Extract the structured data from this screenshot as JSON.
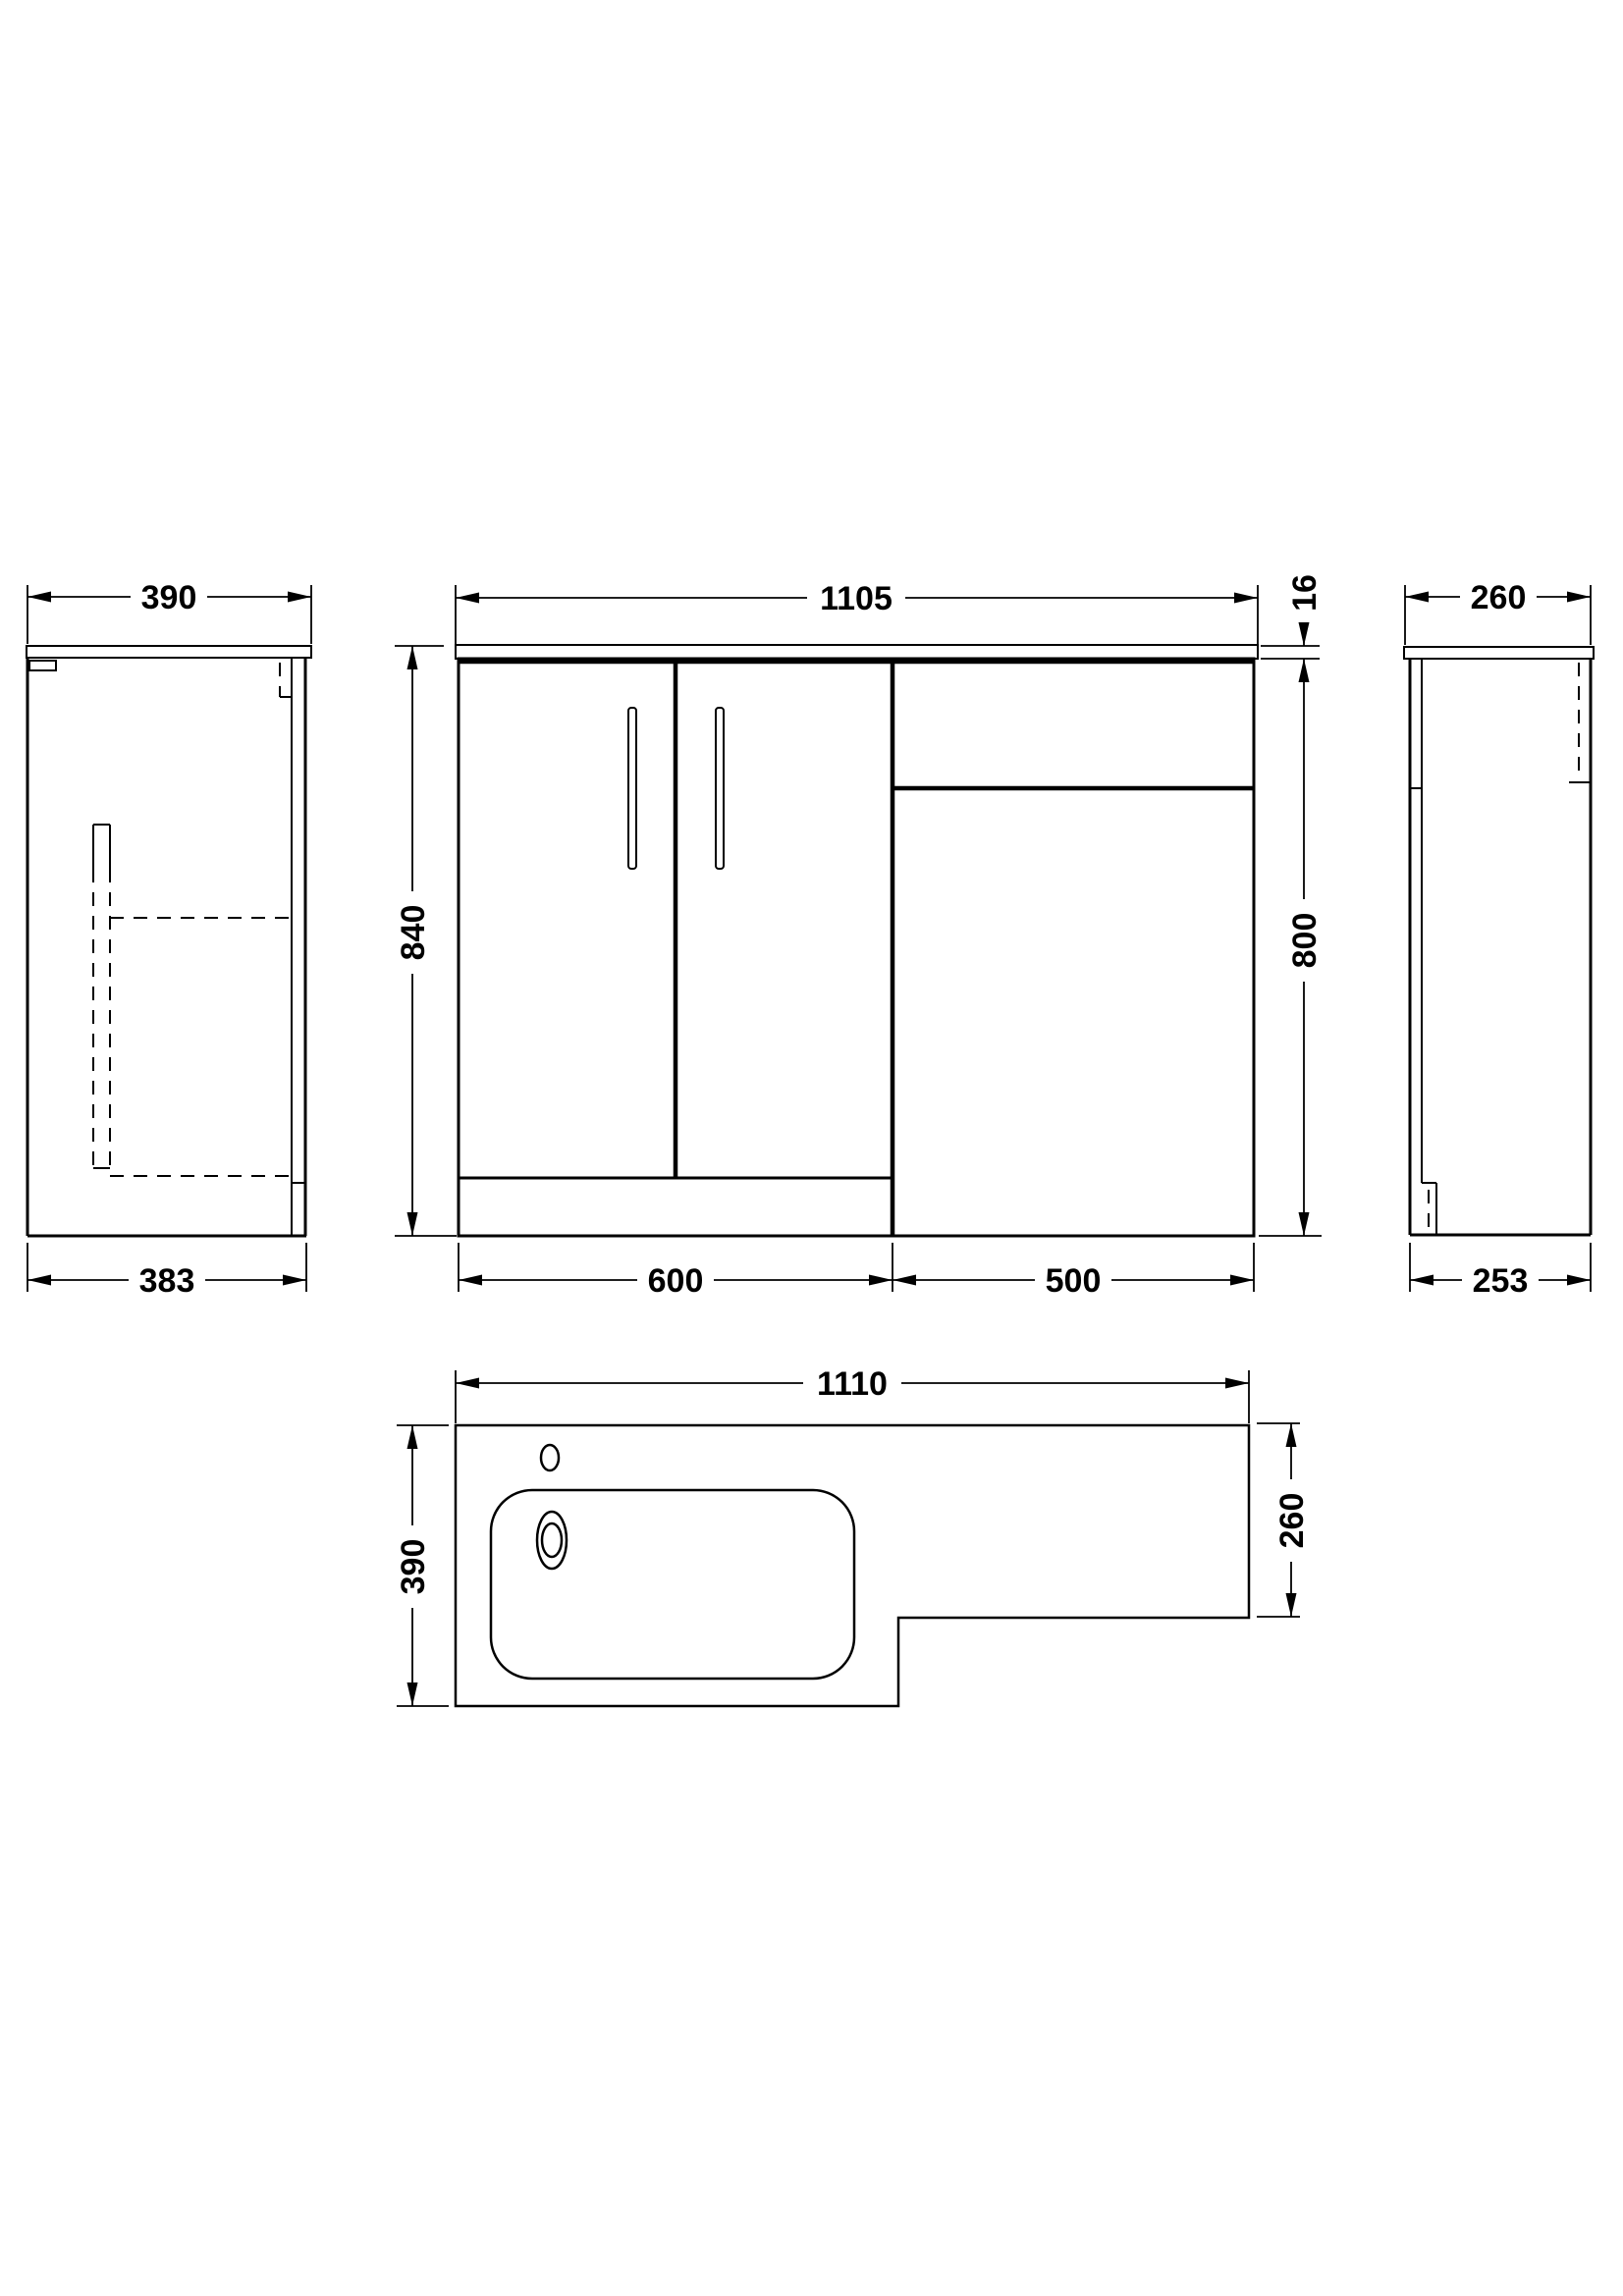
{
  "title": "Bathroom vanity and WC unit technical drawing",
  "colors": {
    "line": "#000000",
    "background": "#ffffff"
  },
  "views": {
    "side_left": {
      "name": "Left side view",
      "dim_width_top": "390",
      "dim_width_bottom": "383"
    },
    "front": {
      "name": "Front view",
      "dim_width_top": "1105",
      "dim_height_total": "840",
      "dim_counter_thickness": "16",
      "dim_height_cabinet": "800",
      "dim_width_vanity": "600",
      "dim_width_wc": "500"
    },
    "side_right": {
      "name": "Right side view",
      "dim_width_top": "260",
      "dim_width_bottom": "253"
    },
    "plan": {
      "name": "Plan view of basin top",
      "dim_width": "1110",
      "dim_depth_total": "390",
      "dim_depth_wc": "260"
    }
  }
}
